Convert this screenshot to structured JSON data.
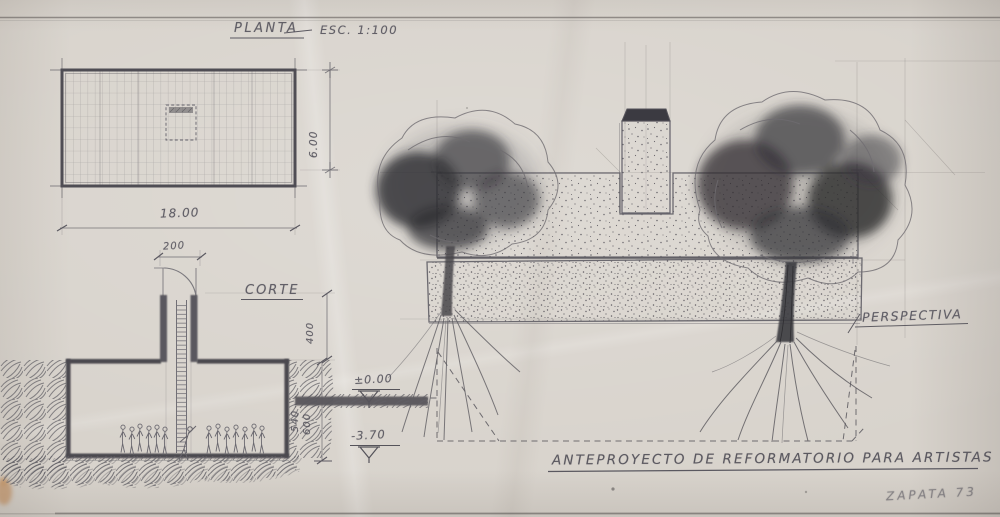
{
  "labels": {
    "plan_title": "PLANTA",
    "plan_scale": "ESC. 1:100",
    "section_title": "CORTE",
    "perspective_title": "PERSPECTIVA",
    "main_title": "ANTEPROYECTO DE REFORMATORIO PARA ARTISTAS",
    "signature": "ZAPATA 73"
  },
  "dimensions": {
    "plan_width": "18.00",
    "shaft_width": "200",
    "plan_depth": "6.00",
    "shaft_height": "400",
    "room_depth_inner": "540",
    "room_depth_outer": "600",
    "level_ground": "±0.00",
    "level_floor": "-3.70"
  },
  "colors": {
    "paper": "#d8d3cc",
    "pencil": "#5f5d63",
    "charcoal": "#2c2b2f"
  }
}
